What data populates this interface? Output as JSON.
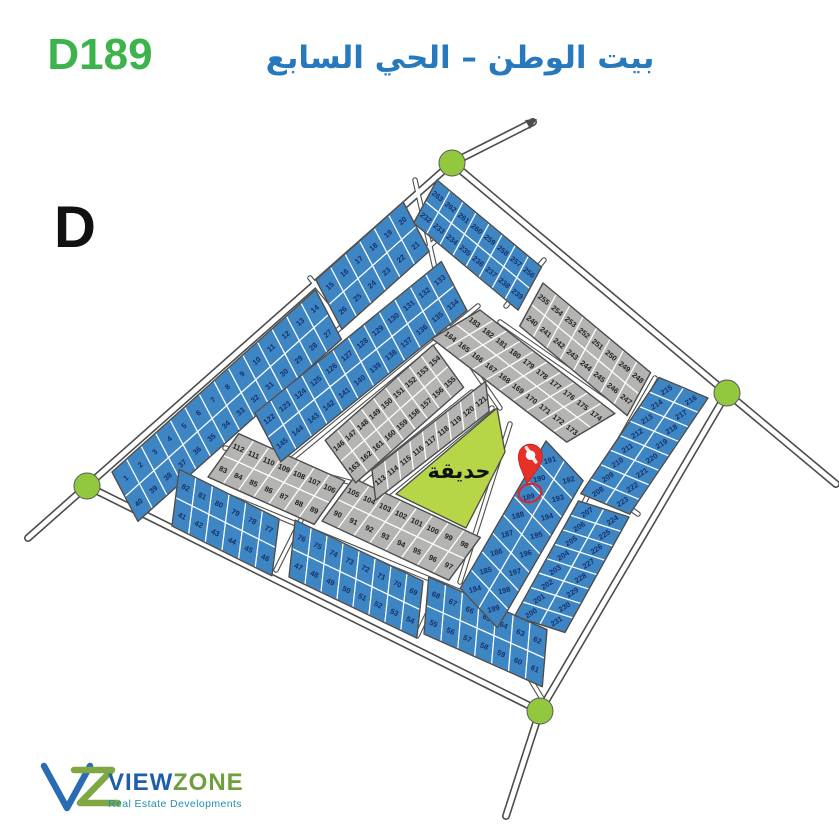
{
  "header": {
    "plot_code": "D189",
    "title": "بيت الوطن – الحي السابع",
    "zone_letter": "D"
  },
  "logo": {
    "view": "VIEW",
    "zone": "ZONE",
    "tagline": "Real Estate Developments",
    "monogram_v": "V",
    "monogram_z": "Z"
  },
  "map": {
    "park_label": "حديقة",
    "selected_plot": "189",
    "colors": {
      "blue_plot": "#3e86c3",
      "gray_plot": "#b4b4b2",
      "park": "#b6d647",
      "roundabout": "#92c83e",
      "road": "#4d4d4d",
      "outline": "#4a4a4a",
      "number_blue": "#16316d",
      "number_gray": "#1f1f1f",
      "pin": "#e73027",
      "ring": "#d7282b",
      "title": "#2779bd",
      "code": "#3cb44b",
      "zone_letter": "#111111",
      "logo_view": "#1f5ea8",
      "logo_zone": "#6f9e3e",
      "logo_mark_v": "#2a6cb4",
      "logo_mark_z": "#7fa843",
      "logo_tagline": "#2090ad"
    },
    "roundabouts": [
      [
        452,
        163
      ],
      [
        87,
        486
      ],
      [
        727,
        393
      ],
      [
        540,
        711
      ]
    ],
    "roundabout_radius": 13,
    "roads": [
      [
        28,
        538,
        452,
        163,
        8
      ],
      [
        452,
        163,
        727,
        393,
        8
      ],
      [
        727,
        393,
        836,
        484,
        8
      ],
      [
        727,
        393,
        540,
        711,
        8
      ],
      [
        540,
        711,
        506,
        816,
        8
      ],
      [
        87,
        486,
        540,
        711,
        8
      ],
      [
        452,
        163,
        533,
        122,
        8
      ],
      [
        146,
        505,
        456,
        222,
        5.5
      ],
      [
        500,
        322,
        618,
        404,
        5.5
      ],
      [
        655,
        378,
        588,
        495,
        5.5
      ],
      [
        588,
        495,
        530,
        610,
        5.5
      ],
      [
        165,
        470,
        505,
        610,
        5.5
      ],
      [
        415,
        180,
        450,
        335,
        5.5
      ],
      [
        450,
        335,
        500,
        408,
        5.5
      ],
      [
        510,
        424,
        460,
        582,
        5.5
      ],
      [
        392,
        500,
        468,
        538,
        5.5
      ],
      [
        362,
        480,
        472,
        392,
        5.5
      ],
      [
        225,
        448,
        360,
        485,
        5.5
      ],
      [
        293,
        458,
        478,
        306,
        5.5
      ],
      [
        544,
        260,
        506,
        306,
        5.5
      ],
      [
        310,
        278,
        346,
        322,
        5.5
      ],
      [
        276,
        570,
        302,
        518,
        5.5
      ],
      [
        417,
        636,
        441,
        585,
        5.5
      ],
      [
        638,
        514,
        593,
        482,
        5.5
      ],
      [
        544,
        702,
        478,
        592,
        5.5
      ],
      [
        385,
        496,
        492,
        408,
        5.5
      ]
    ],
    "arrow_points": "537,119 530,129 525,120",
    "park_polygon": [
      [
        497,
        408
      ],
      [
        505,
        452
      ],
      [
        466,
        528
      ],
      [
        396,
        494
      ]
    ],
    "park_label_pos": [
      459,
      478
    ],
    "pin": {
      "x": 527,
      "y": 484,
      "lean": 7
    },
    "ring": {
      "x": 530,
      "y": 493,
      "rx": 11.5,
      "ry": 9,
      "angle": -15
    },
    "blocks": [
      {
        "id": "nw-a",
        "color": "blue",
        "x": 112,
        "y": 472,
        "angle": -41.8,
        "cw": 19.5,
        "ch": 27,
        "skew": -0.25,
        "vflip": 1,
        "text_angle": -41,
        "rows": [
          [
            1,
            2,
            3,
            4,
            5,
            6,
            7,
            8,
            9,
            10,
            11,
            12,
            13,
            14
          ],
          [
            40,
            39,
            38,
            37,
            36,
            35,
            34,
            33,
            32,
            31,
            30,
            29,
            28,
            27
          ]
        ]
      },
      {
        "id": "nw-b",
        "color": "blue",
        "x": 316,
        "y": 280,
        "angle": -41.8,
        "cw": 19.5,
        "ch": 27,
        "skew": -0.25,
        "vflip": 1,
        "text_angle": -41,
        "rows": [
          [
            15,
            16,
            17,
            18,
            19,
            20
          ],
          [
            26,
            25,
            24,
            23,
            22,
            21
          ]
        ]
      },
      {
        "id": "ne-a",
        "color": "blue",
        "x": 437,
        "y": 180,
        "angle": 39.8,
        "cw": 17,
        "ch": 24,
        "skew": 0.2,
        "vflip": 1,
        "text_angle": 39,
        "rows": [
          [
            263,
            262,
            261,
            260,
            259,
            258,
            257,
            256
          ],
          [
            232,
            233,
            234,
            235,
            236,
            237,
            238,
            239
          ]
        ]
      },
      {
        "id": "ne-b",
        "color": "gray",
        "x": 543,
        "y": 283,
        "angle": 39.8,
        "cw": 17.5,
        "ch": 24,
        "skew": 0.2,
        "vflip": 1,
        "text_angle": 39,
        "rows": [
          [
            255,
            254,
            253,
            252,
            251,
            250,
            249,
            248
          ],
          [
            240,
            241,
            242,
            243,
            244,
            245,
            246,
            247
          ]
        ]
      },
      {
        "id": "se-a",
        "color": "blue",
        "x": 708,
        "y": 398,
        "angle": 124,
        "cw": 17.5,
        "ch": 26,
        "skew": 0.2,
        "vflip": 1,
        "text_angle": -33,
        "rows": [
          [
            216,
            217,
            218,
            219,
            220,
            221,
            222,
            223
          ],
          [
            215,
            214,
            213,
            212,
            211,
            210,
            209,
            208
          ]
        ]
      },
      {
        "id": "se-b",
        "color": "blue",
        "x": 629,
        "y": 517,
        "angle": 119,
        "cw": 16.5,
        "ch": 26,
        "skew": 0.2,
        "vflip": 1,
        "text_angle": -33,
        "rows": [
          [
            224,
            225,
            226,
            227,
            228,
            229,
            230,
            231
          ],
          [
            207,
            206,
            205,
            204,
            203,
            202,
            201,
            200
          ]
        ]
      },
      {
        "id": "sw-a",
        "color": "blue",
        "x": 172,
        "y": 526,
        "angle": 26.5,
        "cw": 18.6,
        "ch": 27,
        "skew": -0.35,
        "vflip": -1,
        "text_angle": 25,
        "rows": [
          [
            41,
            42,
            43,
            44,
            45,
            46
          ],
          [
            82,
            81,
            80,
            79,
            78,
            77
          ]
        ]
      },
      {
        "id": "sw-b",
        "color": "blue",
        "x": 289,
        "y": 577,
        "angle": 25.5,
        "cw": 17.7,
        "ch": 27,
        "skew": -0.35,
        "vflip": -1,
        "text_angle": 25,
        "rows": [
          [
            47,
            48,
            49,
            50,
            51,
            52,
            53,
            54
          ],
          [
            76,
            75,
            74,
            73,
            72,
            71,
            70,
            69
          ]
        ]
      },
      {
        "id": "sw-c",
        "color": "blue",
        "x": 424,
        "y": 634,
        "angle": 24,
        "cw": 18.5,
        "ch": 27,
        "skew": -0.35,
        "vflip": -1,
        "text_angle": 24,
        "rows": [
          [
            55,
            56,
            57,
            58,
            59,
            60,
            61
          ],
          [
            68,
            67,
            66,
            65,
            64,
            63,
            62
          ]
        ]
      },
      {
        "id": "gray-a",
        "color": "gray",
        "x": 208,
        "y": 477,
        "angle": 24,
        "cw": 16.6,
        "ch": 26,
        "skew": 0.2,
        "vflip": -1,
        "text_angle": 24,
        "rows": [
          [
            83,
            84,
            85,
            86,
            87,
            88,
            89
          ],
          [
            112,
            111,
            110,
            109,
            108,
            107,
            106
          ]
        ]
      },
      {
        "id": "gray-b",
        "color": "gray",
        "x": 322,
        "y": 521,
        "angle": 25,
        "cw": 17.5,
        "ch": 26,
        "skew": 0.2,
        "vflip": -1,
        "text_angle": 25,
        "rows": [
          [
            90,
            91,
            92,
            93,
            94,
            95,
            96,
            97
          ],
          [
            105,
            104,
            103,
            102,
            101,
            100,
            99,
            98
          ]
        ]
      },
      {
        "id": "gray-c",
        "color": "gray",
        "x": 372,
        "y": 470,
        "angle": -38,
        "cw": 16,
        "ch": 26,
        "skew": -0.6,
        "vflip": 1,
        "text_angle": -38,
        "rows": [
          [
            113,
            114,
            115,
            116,
            117,
            118,
            119,
            120,
            121
          ]
        ]
      },
      {
        "id": "gray-d",
        "color": "gray",
        "x": 433,
        "y": 345,
        "angle": 138.5,
        "cw": 16,
        "ch": 26,
        "skew": 0.1,
        "vflip": -1,
        "text_angle": -41,
        "rows": [
          [
            154,
            153,
            152,
            151,
            150,
            149,
            148,
            147,
            146
          ],
          [
            155,
            156,
            157,
            158,
            159,
            160,
            161,
            162,
            163
          ]
        ]
      },
      {
        "id": "gray-e",
        "color": "gray",
        "x": 480,
        "y": 310,
        "angle": 37.5,
        "cw": 17,
        "ch": 26,
        "skew": -0.4,
        "vflip": 1,
        "text_angle": 37,
        "rows": [
          [
            183,
            182,
            181,
            180,
            179,
            178,
            177,
            176,
            175,
            174
          ],
          [
            164,
            165,
            166,
            167,
            168,
            169,
            170,
            171,
            172,
            173
          ]
        ]
      },
      {
        "id": "mid-blue",
        "color": "blue",
        "x": 255,
        "y": 413,
        "angle": -39.1,
        "cw": 20,
        "ch": 27,
        "skew": -0.2,
        "vflip": 1,
        "text_angle": -39,
        "rows": [
          [
            122,
            123,
            124,
            125,
            126,
            127,
            128,
            129,
            130,
            131,
            132,
            133
          ],
          [
            145,
            144,
            143,
            142,
            141,
            140,
            139,
            138,
            137,
            136,
            135,
            134
          ]
        ]
      },
      {
        "id": "pin-strip",
        "color": "blue",
        "x": 546,
        "y": 441,
        "angle": 120.2,
        "cw": 21.3,
        "ch": 26,
        "skew": 0.3,
        "vflip": -1,
        "text_angle": -15,
        "rows": [
          [
            191,
            190,
            189,
            188,
            187,
            186,
            185,
            184
          ],
          [
            192,
            193,
            194,
            195,
            196,
            197,
            198,
            199
          ]
        ]
      }
    ]
  }
}
